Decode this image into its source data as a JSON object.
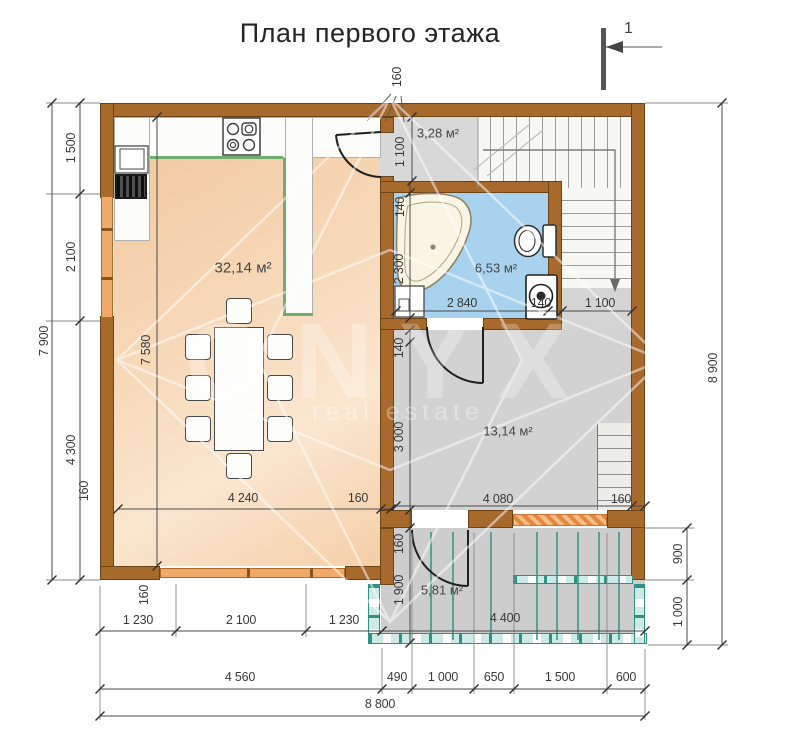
{
  "title": "План первого этажа",
  "section_marker": "1",
  "watermark": {
    "brand": "ONYX",
    "tagline": "real estate"
  },
  "rooms": {
    "kitchen_living": "32,14 м²",
    "hall": "3,28 м²",
    "bathroom": "6,53 м²",
    "room": "13,14 м²",
    "porch": "5,81 м²"
  },
  "dims": {
    "left_total": "7 900",
    "left_seg1": "1 500",
    "left_seg2": "2 100",
    "left_seg3": "4 300",
    "left_wall": "160",
    "top_wall": "160",
    "right_total": "8 900",
    "right_seg1": "900",
    "right_seg2": "1 000",
    "bottom1_a": "1 230",
    "bottom1_b": "2 100",
    "bottom1_c": "1 230",
    "bottom1_wall": "160",
    "bottom2_a": "4 560",
    "bottom2_b": "490",
    "bottom2_c": "1 000",
    "bottom2_d": "650",
    "bottom2_e": "1 500",
    "bottom2_f": "600",
    "bottom_total": "8 800",
    "living_h": "7 580",
    "living_w": "4 240",
    "living_wall": "160",
    "hall_h": "1 100",
    "bath_gap": "140",
    "bath_h": "2 300",
    "bath_w": "2 840",
    "bath_wall": "140",
    "landing_w": "1 100",
    "room_gap": "140",
    "room_h": "3 000",
    "room_w": "4 080",
    "room_wall": "160",
    "porch_wall": "160",
    "porch_h": "1 900",
    "porch_w": "4 400"
  },
  "colors": {
    "wall_brown": "#a8692c",
    "window_orange": "#efa968",
    "bathroom_blue": "#a9d2ee",
    "kitchen_peach": "#f4cfa8",
    "floor_gray": "#d4d4d4",
    "porch_teal": "#2f9183",
    "counter_green": "#6fae6e"
  }
}
